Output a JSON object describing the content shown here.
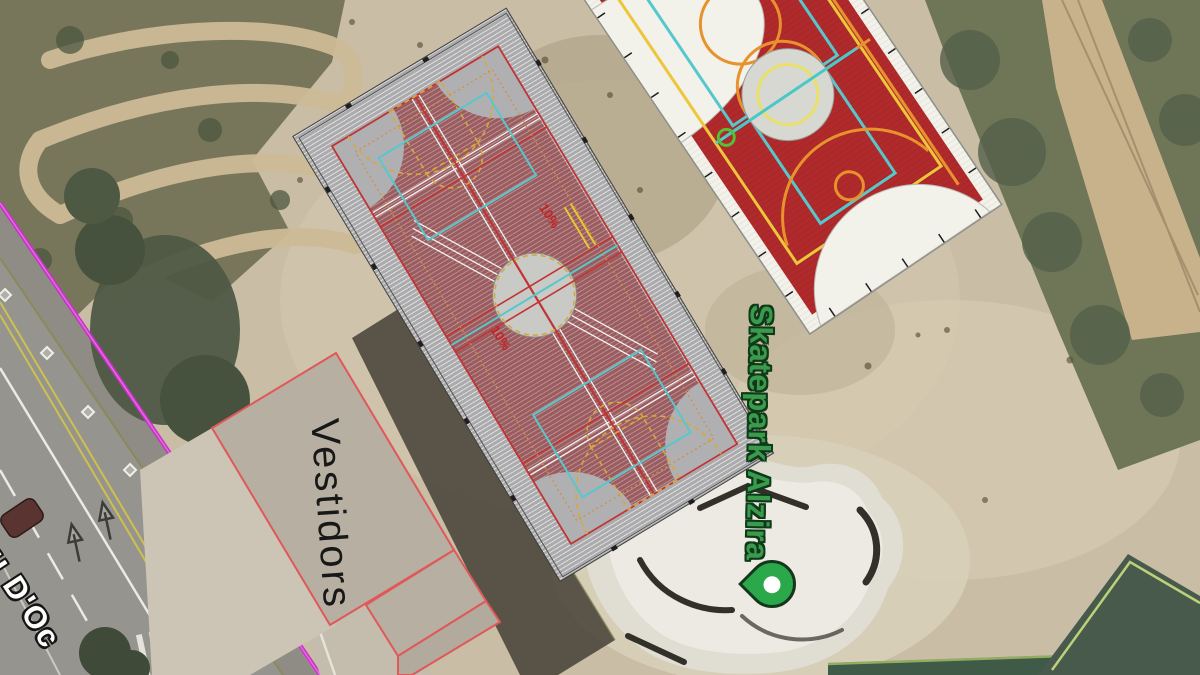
{
  "canvas": {
    "type": "satellite-map-with-cad-overlay",
    "place": "sports complex aerial view"
  },
  "labels": {
    "building": "Vestidors",
    "poi": "Skatepark Alzira",
    "street_fragment": "u D'Oc",
    "slopes": [
      "10%",
      "10%"
    ]
  },
  "markers": {
    "poi_pin": {
      "icon": "location-pin",
      "color": "#2ba84a",
      "dot_color": "#ffffff"
    }
  },
  "colors": {
    "court_red": "#b02a2c",
    "court_line_yellow": "#ecc73c",
    "court_line_orange": "#e8922e",
    "court_line_cyan": "#56c8cc",
    "cad_maroon": "#9a5c5f",
    "cad_gray": "#ababad",
    "boundary_magenta": "#c633c6",
    "poi_text_green": "#3b9a4c",
    "slope_text_red": "#c22222",
    "vegetation_green": "#6e7657",
    "dirt_tan": "#c9bda5",
    "skatepark_concrete": "#e0ddd3",
    "dark_green_court": "#485a4c"
  }
}
